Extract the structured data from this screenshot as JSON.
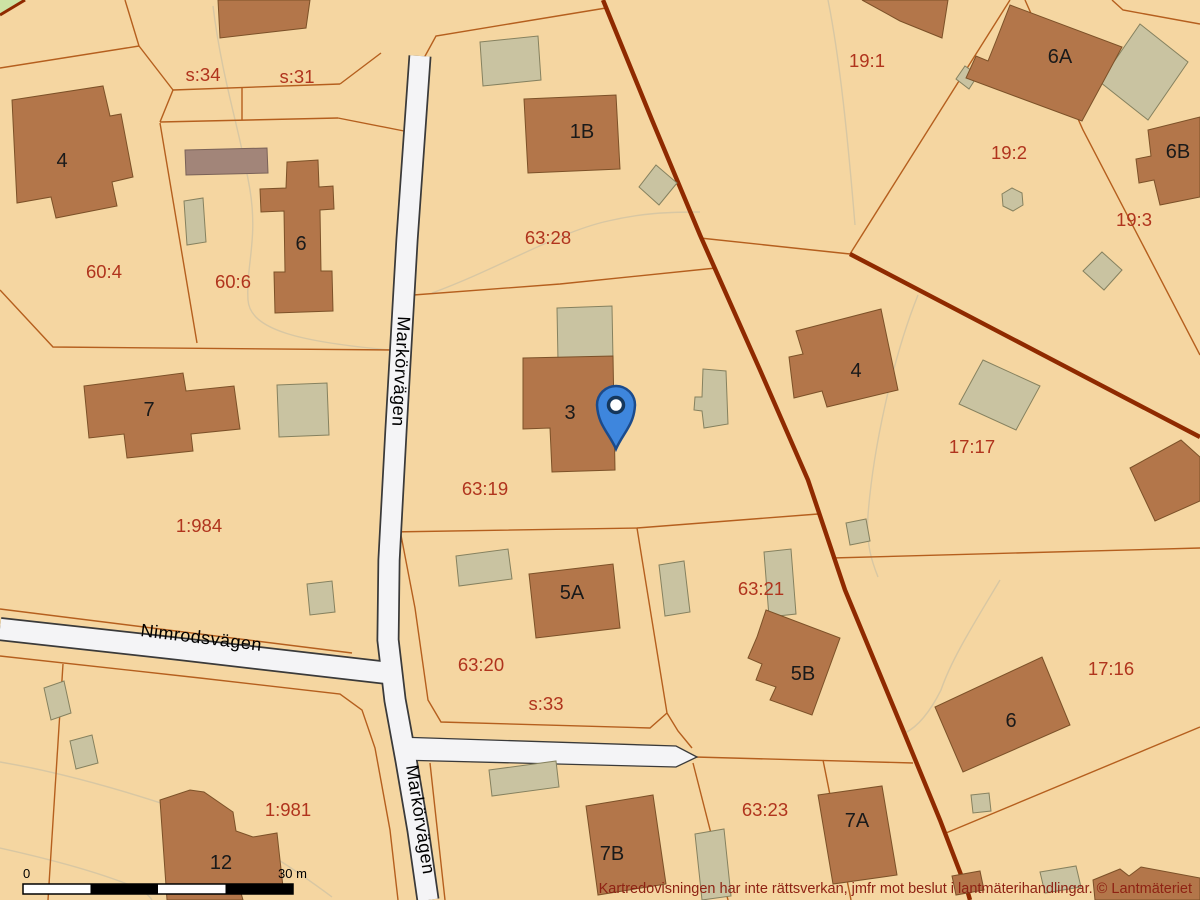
{
  "map": {
    "type": "cadastral-map",
    "attribution": "Kartredovisningen har inte rättsverkan, jmfr mot beslut i lantmäterihandlingar. © Lantmäteriet",
    "scale_bar": {
      "start_label": "0",
      "end_label": "30 m"
    },
    "road_labels": [
      {
        "id": "markorvagen-north",
        "text": "Markörvägen"
      },
      {
        "id": "nimrodsvagen",
        "text": "Nimrodsvägen"
      },
      {
        "id": "markorvagen-south",
        "text": "Markörvägen"
      }
    ],
    "parcel_labels": [
      {
        "text": "s:34"
      },
      {
        "text": "s:31"
      },
      {
        "text": "60:4"
      },
      {
        "text": "60:6"
      },
      {
        "text": "63:28"
      },
      {
        "text": "1:984"
      },
      {
        "text": "63:19"
      },
      {
        "text": "63:20"
      },
      {
        "text": "s:33"
      },
      {
        "text": "63:21"
      },
      {
        "text": "63:23"
      },
      {
        "text": "1:981"
      },
      {
        "text": "19:1"
      },
      {
        "text": "19:2"
      },
      {
        "text": "19:3"
      },
      {
        "text": "17:17"
      },
      {
        "text": "17:16"
      }
    ],
    "building_labels": [
      {
        "text": "4"
      },
      {
        "text": "6"
      },
      {
        "text": "7"
      },
      {
        "text": "12"
      },
      {
        "text": "1B"
      },
      {
        "text": "3"
      },
      {
        "text": "4"
      },
      {
        "text": "6A"
      },
      {
        "text": "6B"
      },
      {
        "text": "5A"
      },
      {
        "text": "5B"
      },
      {
        "text": "7A"
      },
      {
        "text": "7B"
      },
      {
        "text": "6"
      }
    ],
    "marker": {
      "name": "location-pin",
      "color": "#3e86dd"
    },
    "colors": {
      "background": "#f5d6a1",
      "parcel_boundary": "#b55f1e",
      "major_boundary": "#8f2a00",
      "building_main": "#b3764a",
      "building_outbuilding": "#c9c3a1",
      "building_special": "#a28579",
      "road_fill": "#f4f4f6",
      "road_edge": "#3a3a3a",
      "green_area": "#cde3a4",
      "parcel_label": "#b0341d",
      "building_label": "#1a1a1a",
      "attribution_text": "#8e2213"
    }
  }
}
